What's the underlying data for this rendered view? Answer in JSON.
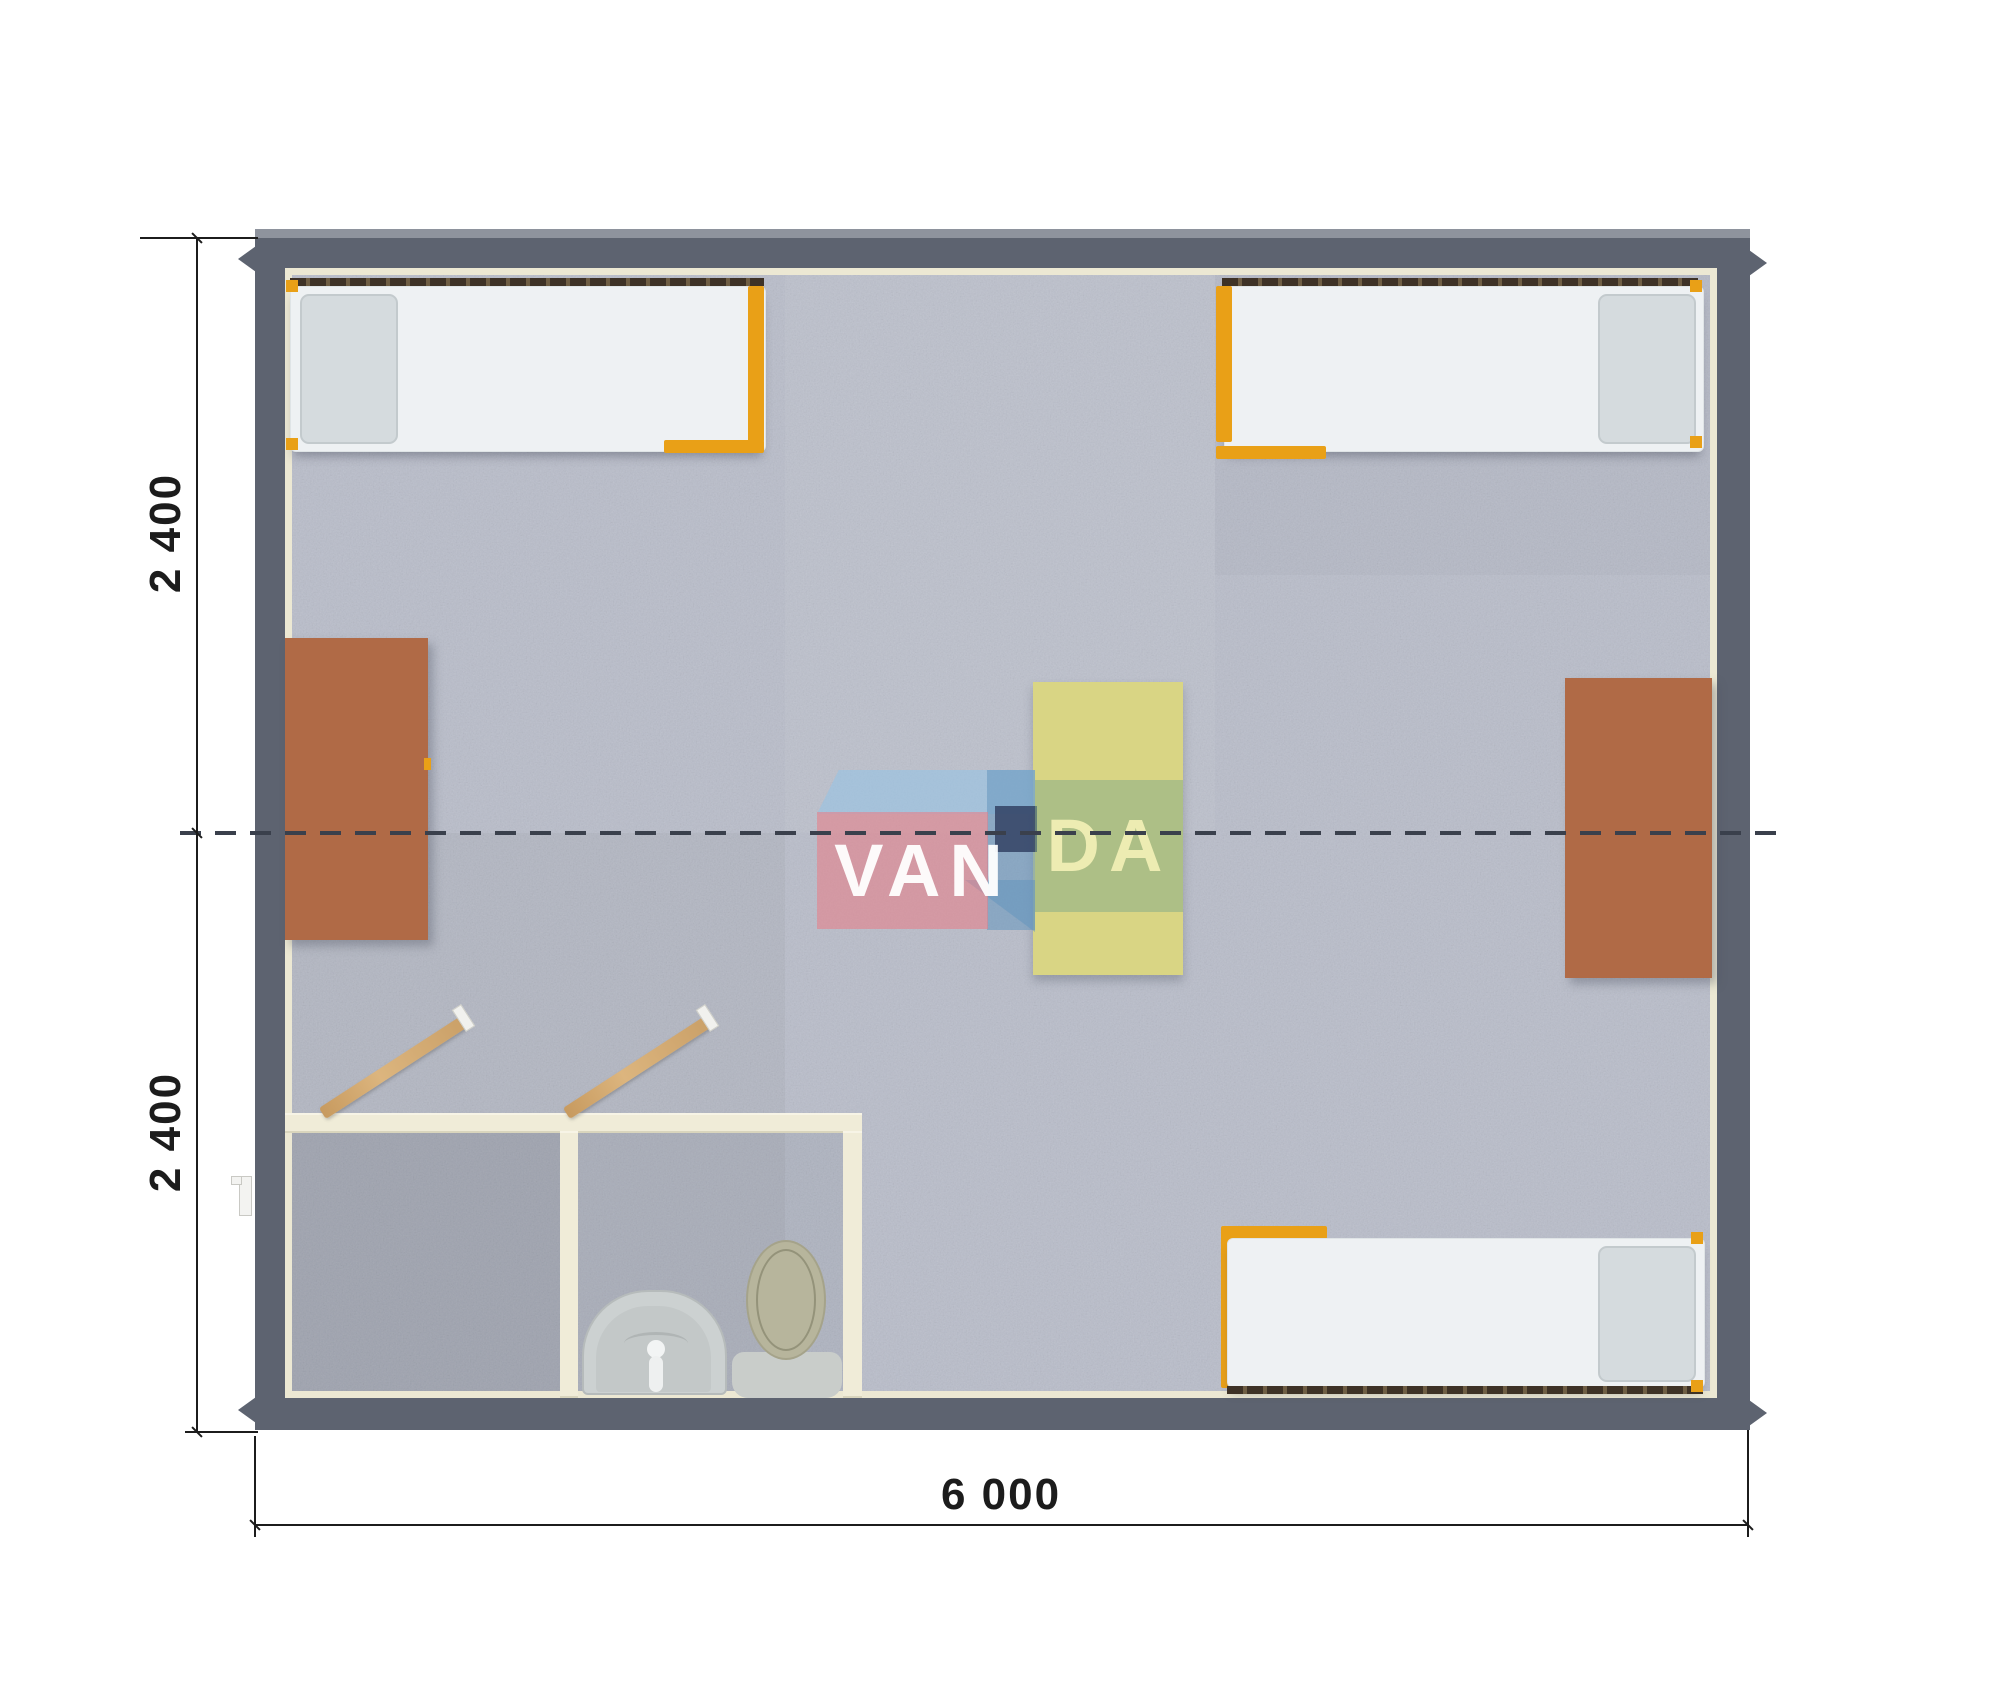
{
  "watermark": {
    "left": "VAN",
    "right": "DA"
  },
  "dimensions": {
    "left_top": "2 400",
    "left_bottom": "2 400",
    "bottom": "6 000"
  },
  "furniture": [
    "bed-top-left",
    "bed-top-right",
    "bed-bottom-right",
    "desk-left",
    "desk-right",
    "table-center",
    "wash-basin",
    "toilet",
    "door-left-open",
    "door-right-open",
    "entry-door-handle"
  ],
  "colors": {
    "wall": "#5d6370",
    "wall_edge": "#8e939d",
    "liner": "#ece8d3",
    "carpet": "#b9bdca",
    "bed_frame": "#e9a017",
    "mattress": "#eef1f3",
    "pillow": "#d5dbde",
    "rail": "#3e3226",
    "table_brown": "#b06a46",
    "table_yellow": "#d9d584",
    "bath_wall": "#f0ecd8",
    "fixture": "#ccd1d1",
    "toilet_lid": "#b7b59c",
    "dash": "#3a404c",
    "dim": "#1c1c1c",
    "logo_pink": "rgba(228,130,140,0.62)",
    "logo_blue": "rgba(150,195,228,0.60)",
    "logo_blue_dark": "rgba(100,150,190,0.55)",
    "logo_navy": "rgba(50,66,100,0.85)",
    "logo_green": "rgba(130,170,135,0.50)",
    "logo_text_left": "rgba(255,255,255,0.95)",
    "logo_text_right": "rgba(240,238,180,0.95)"
  }
}
